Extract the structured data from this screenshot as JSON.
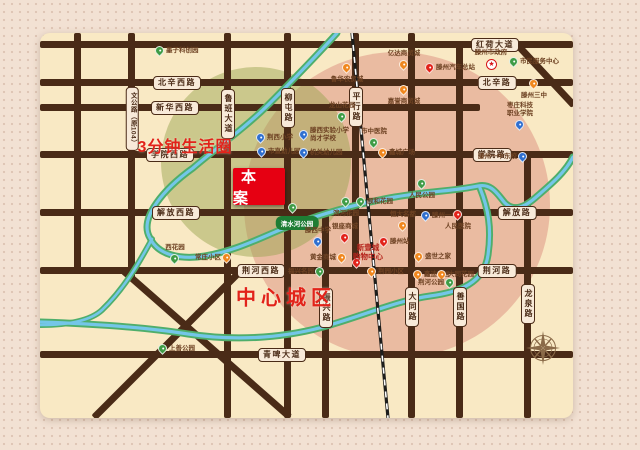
{
  "site_label": "本案",
  "zones": [
    {
      "label": "3分钟生活圈",
      "x": 145,
      "y": 112,
      "size": 16
    },
    {
      "label": "中心城区",
      "x": 246,
      "y": 263,
      "size": 20
    }
  ],
  "road_labels": [
    {
      "label": "红荷大道",
      "orient": "h",
      "x": 455,
      "y": 12
    },
    {
      "label": "北辛西路",
      "orient": "h",
      "x": 137,
      "y": 50
    },
    {
      "label": "北辛路",
      "orient": "h",
      "x": 457,
      "y": 50
    },
    {
      "label": "新华西路",
      "orient": "h",
      "x": 135,
      "y": 75
    },
    {
      "label": "学院西路",
      "orient": "h",
      "x": 130,
      "y": 122
    },
    {
      "label": "学院路",
      "orient": "h",
      "x": 452,
      "y": 122
    },
    {
      "label": "解放西路",
      "orient": "h",
      "x": 136,
      "y": 180
    },
    {
      "label": "解放路",
      "orient": "h",
      "x": 477,
      "y": 180
    },
    {
      "label": "荆河西路",
      "orient": "h",
      "x": 221,
      "y": 238
    },
    {
      "label": "荆河路",
      "orient": "h",
      "x": 457,
      "y": 238
    },
    {
      "label": "青啤大道",
      "orient": "h",
      "x": 242,
      "y": 322
    },
    {
      "label": "文公路（原104）",
      "orient": "v",
      "x": 92,
      "y": 86,
      "small": true
    },
    {
      "label": "鲁班大道",
      "orient": "v",
      "x": 188,
      "y": 81
    },
    {
      "label": "柳屯路",
      "orient": "v",
      "x": 248,
      "y": 75
    },
    {
      "label": "平行路",
      "orient": "v",
      "x": 316,
      "y": 74
    },
    {
      "label": "振兴路",
      "orient": "v",
      "x": 286,
      "y": 275
    },
    {
      "label": "大同路",
      "orient": "v",
      "x": 372,
      "y": 274
    },
    {
      "label": "善国路",
      "orient": "v",
      "x": 420,
      "y": 274
    },
    {
      "label": "龙泉路",
      "orient": "v",
      "x": 488,
      "y": 271
    }
  ],
  "pois": [
    {
      "name": "墨子科创园",
      "color": "green",
      "x": 120,
      "y": 24,
      "side": "r"
    },
    {
      "name": "鲁华农贸城",
      "color": "orange",
      "x": 307,
      "y": 41,
      "side": "b"
    },
    {
      "name": "亿达商贸城",
      "color": "orange",
      "x": 364,
      "y": 38,
      "side": "t"
    },
    {
      "name": "滕州汽车总站",
      "color": "red",
      "x": 390,
      "y": 41,
      "side": "r"
    },
    {
      "name": "嘉誉商贸城",
      "color": "orange",
      "x": 364,
      "y": 63,
      "side": "b"
    },
    {
      "name": "滕州市政府",
      "color": "star",
      "x": 451,
      "y": 37,
      "side": "t"
    },
    {
      "name": "市民服务中心",
      "color": "green",
      "x": 474,
      "y": 35,
      "side": "r"
    },
    {
      "name": "滕州三中",
      "color": "orange",
      "x": 494,
      "y": 57,
      "side": "b"
    },
    {
      "name": "枣庄科技",
      "name2": "职业学院",
      "color": "blue",
      "x": 480,
      "y": 98,
      "side": "t"
    },
    {
      "name": "滕州一中东校",
      "color": "blue",
      "x": 483,
      "y": 130,
      "side": "l"
    },
    {
      "name": "荆西小学",
      "color": "blue",
      "x": 221,
      "y": 111,
      "side": "r"
    },
    {
      "name": "滕西实验小学",
      "name2": "尚才学校",
      "color": "blue",
      "x": 264,
      "y": 108,
      "side": "r"
    },
    {
      "name": "市直幼儿园",
      "color": "blue",
      "x": 222,
      "y": 125,
      "side": "r"
    },
    {
      "name": "机关幼儿园",
      "color": "blue",
      "x": 264,
      "y": 126,
      "side": "r"
    },
    {
      "name": "龙山花园",
      "color": "green",
      "x": 302,
      "y": 90,
      "side": "t"
    },
    {
      "name": "市中医院",
      "color": "green",
      "x": 334,
      "y": 116,
      "side": "t"
    },
    {
      "name": "鑫城广场",
      "color": "orange",
      "x": 343,
      "y": 126,
      "side": "r"
    },
    {
      "name": "人民公园",
      "color": "green",
      "x": 382,
      "y": 157,
      "side": "b"
    },
    {
      "name": "滨河花园",
      "color": "green",
      "x": 306,
      "y": 175,
      "side": "b"
    },
    {
      "name": "颐和花园",
      "color": "green",
      "x": 321,
      "y": 175,
      "side": "r"
    },
    {
      "name": "滕西中学",
      "color": "blue",
      "x": 278,
      "y": 215,
      "side": "t"
    },
    {
      "name": "银座商城",
      "color": "red",
      "x": 305,
      "y": 211,
      "side": "t"
    },
    {
      "name": "黄金商城",
      "color": "orange",
      "x": 302,
      "y": 231,
      "side": "l"
    },
    {
      "name": "",
      "color": "red",
      "x": 317,
      "y": 236,
      "side": "none"
    },
    {
      "name": "滕州站",
      "color": "red",
      "x": 344,
      "y": 215,
      "side": "r"
    },
    {
      "name": "滕州一中",
      "color": "blue",
      "x": 386,
      "y": 189,
      "side": "r"
    },
    {
      "name": "人民医院",
      "color": "red",
      "x": 418,
      "y": 188,
      "side": "b"
    },
    {
      "name": "恒大名都",
      "color": "orange",
      "x": 363,
      "y": 199,
      "side": "t"
    },
    {
      "name": "盛世之家",
      "color": "orange",
      "x": 379,
      "y": 230,
      "side": "r"
    },
    {
      "name": "鑫迪家居",
      "color": "orange",
      "x": 378,
      "y": 248,
      "side": "r"
    },
    {
      "name": "大同花园",
      "color": "orange",
      "x": 402,
      "y": 248,
      "side": "r"
    },
    {
      "name": "荆河公园",
      "color": "green",
      "x": 410,
      "y": 256,
      "side": "l"
    },
    {
      "name": "福兴名园",
      "color": "green",
      "x": 280,
      "y": 245,
      "side": "l"
    },
    {
      "name": "荆园小区",
      "color": "orange",
      "x": 332,
      "y": 245,
      "side": "r"
    },
    {
      "name": "上善公园",
      "color": "green",
      "x": 123,
      "y": 322,
      "side": "r"
    },
    {
      "name": "西花园",
      "color": "green",
      "x": 135,
      "y": 232,
      "side": "t"
    },
    {
      "name": "常庄小区",
      "color": "orange",
      "x": 187,
      "y": 231,
      "side": "l"
    }
  ],
  "mall": {
    "line1": "新壹城",
    "line2": "购物中心"
  },
  "park": {
    "label": "清水河公园"
  },
  "colors": {
    "road": "#4a2b17",
    "map_bg": "#f9e9c4",
    "page_bg": "#f2e1d3",
    "accent_red": "#e2231a",
    "site_red": "#e60012",
    "zone_pink": "rgba(214,123,112,0.42)",
    "zone_green": "rgba(152,166,80,0.48)",
    "river_blue": "#74c6e8",
    "river_green": "#4fae6b",
    "pin_green": "#3f9c46",
    "pin_blue": "#2f6fd0",
    "pin_orange": "#f0871e",
    "pin_red": "#e2231a"
  }
}
